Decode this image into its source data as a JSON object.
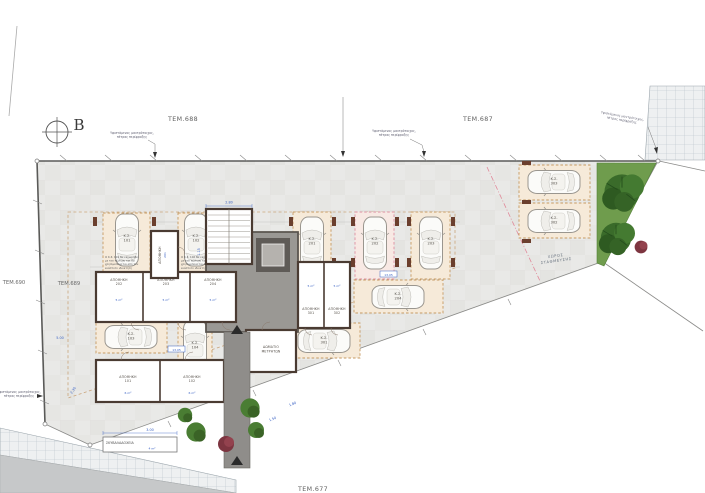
{
  "drawing": {
    "parcels": {
      "top_left": "ΤΕΜ.688",
      "top_right": "ΤΕΜ.687",
      "left_outer": "ΤΕΜ.690",
      "left_inner": "ΤΕΜ.689",
      "bottom": "ΤΕΜ.677"
    },
    "north_label": "Β",
    "notes": {
      "fence_line1": "Υφιστάμενος μαντρότοιχος,",
      "fence_line2": "πέτρας περίφραξης",
      "parking_line1": "ΧΩΡΟΣ",
      "parking_line2": "ΣΤΑΘΜΕΥΣΗΣ",
      "bins_label": "ΣΚΥΒΑΛΑΔΟΧΕΙΑ",
      "bins_area": "4 m²",
      "ks101_lines": [
        "Ο Κ.Σ. 101 θα εκχωρηθεί",
        "με την πώληση και θα",
        "χρησιμοποιείται από τον",
        "εκάστοτε ιδιοκτήτη"
      ],
      "ks102_lines": [
        "Ο Κ.Σ. 102 θα εκχωρηθεί",
        "με την πώληση και θα",
        "χρησιμοποιείται από τον",
        "εκάστοτε ιδιοκτήτη"
      ]
    },
    "rooms": {
      "storage_label": "ΑΠΟΘΗΚΗ",
      "meter_line1": "ΔΩΜΑΤΙΟ",
      "meter_line2": "ΜΕΤΡΗΤΩΝ",
      "storages": [
        {
          "num": "201",
          "area": "3 m²"
        },
        {
          "num": "202",
          "area": "5 m²"
        },
        {
          "num": "203",
          "area": "5 m²"
        },
        {
          "num": "204",
          "area": "5 m²"
        },
        {
          "num": "301",
          "area": "5 m²"
        },
        {
          "num": "302",
          "area": "5 m²"
        },
        {
          "num": "101",
          "area": "6 m²"
        },
        {
          "num": "102",
          "area": "6 m²"
        }
      ]
    },
    "stalls": [
      {
        "code": "Κ.Σ.",
        "num": "101"
      },
      {
        "code": "Κ.Σ.",
        "num": "102"
      },
      {
        "code": "Κ.Σ.",
        "num": "201"
      },
      {
        "code": "Κ.Σ.",
        "num": "202"
      },
      {
        "code": "Κ.Σ.",
        "num": "203"
      },
      {
        "code": "Κ.Σ.",
        "num": "204"
      },
      {
        "code": "Κ.Σ.",
        "num": "301"
      },
      {
        "code": "Κ.Σ.",
        "num": "103"
      },
      {
        "code": "Κ.Σ.",
        "num": "104"
      },
      {
        "code": "Κ.Σ.",
        "num": "303"
      },
      {
        "code": "Κ.Σ.",
        "num": "302"
      }
    ],
    "dimensions": [
      "2.80",
      "1.15",
      "5.00",
      "2.30",
      "3.00",
      "1.50",
      "1.80",
      "13.05",
      "13.05"
    ],
    "colors": {
      "stall_fill": "#f6ead9",
      "stall_border": "#c69a62",
      "green": "#3a6b2a",
      "dim_blue": "#3a62c4",
      "wall": "#4a3b32",
      "corridor": "#9a9894",
      "plot": "#e9e9e7"
    }
  }
}
